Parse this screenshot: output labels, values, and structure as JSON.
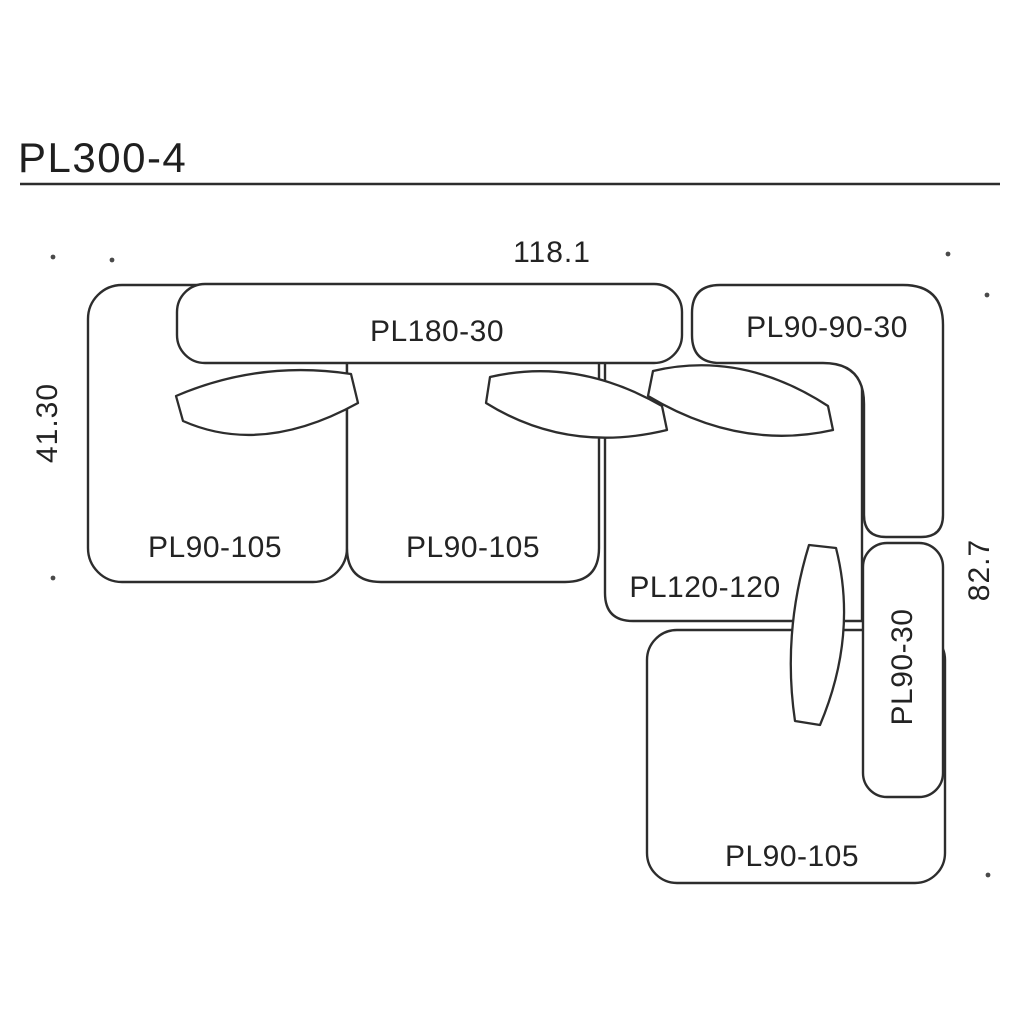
{
  "title": "PL300-4",
  "dimensions": {
    "width_top": "118.1",
    "depth_left": "41.30",
    "depth_right": "82.7"
  },
  "modules": {
    "backrest_long": "PL180-30",
    "corner_backrest": "PL90-90-30",
    "seat_left": "PL90-105",
    "seat_middle": "PL90-105",
    "corner_seat": "PL120-120",
    "backrest_right": "PL90-30",
    "seat_bottom": "PL90-105"
  },
  "colors": {
    "line": "#2d2d2d",
    "text": "#232323",
    "background": "#ffffff"
  }
}
